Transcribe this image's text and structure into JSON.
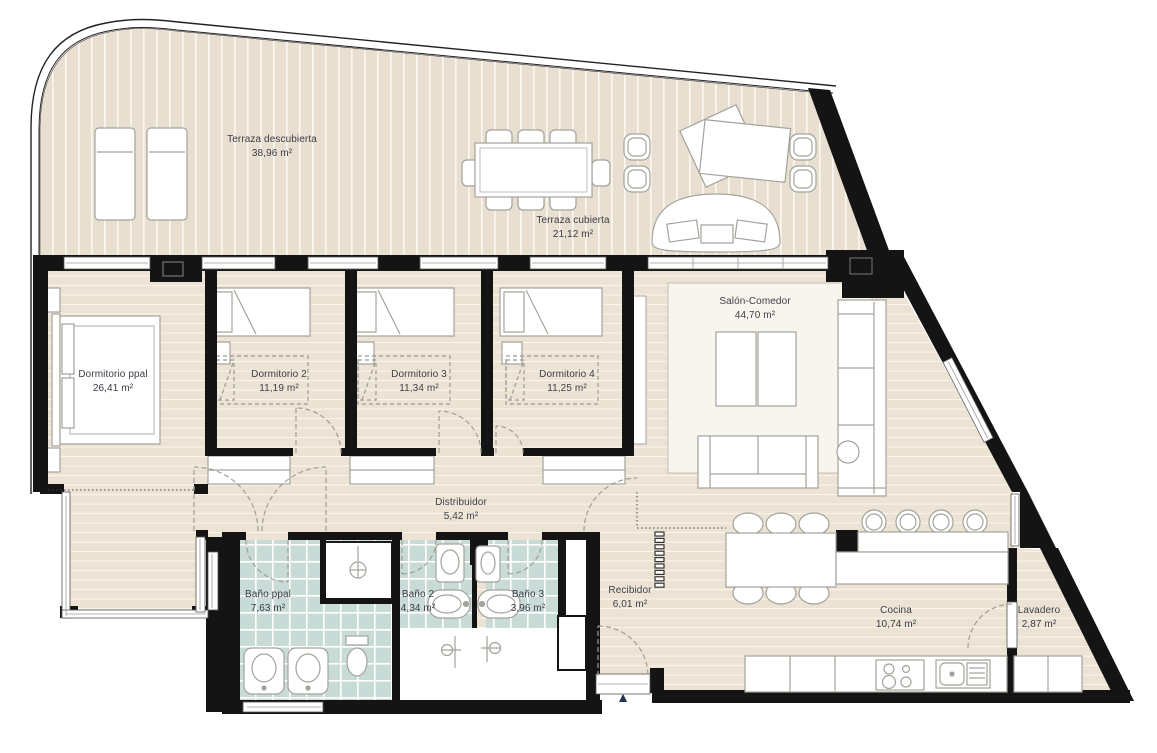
{
  "plan": {
    "type": "apartment floor plan",
    "entrance_marker": "▲",
    "rooms": [
      {
        "id": "terraza-descubierta",
        "name": "Terraza descubierta",
        "area": "38,96 m²"
      },
      {
        "id": "terraza-cubierta",
        "name": "Terraza cubierta",
        "area": "21,12 m²"
      },
      {
        "id": "dormitorio-ppal",
        "name": "Dormitorio ppal",
        "area": "26,41 m²"
      },
      {
        "id": "dormitorio-2",
        "name": "Dormitorio 2",
        "area": "11,19 m²"
      },
      {
        "id": "dormitorio-3",
        "name": "Dormitorio 3",
        "area": "11,34 m²"
      },
      {
        "id": "dormitorio-4",
        "name": "Dormitorio 4",
        "area": "11,25 m²"
      },
      {
        "id": "salon-comedor",
        "name": "Salón-Comedor",
        "area": "44,70 m²"
      },
      {
        "id": "distribuidor",
        "name": "Distribuidor",
        "area": "5,42 m²"
      },
      {
        "id": "bano-ppal",
        "name": "Baño ppal",
        "area": "7,63 m²"
      },
      {
        "id": "bano-2",
        "name": "Baño 2",
        "area": "4,34 m²"
      },
      {
        "id": "bano-3",
        "name": "Baño 3",
        "area": "3,96 m²"
      },
      {
        "id": "recibidor",
        "name": "Recibidor",
        "area": "6,01 m²"
      },
      {
        "id": "cocina",
        "name": "Cocina",
        "area": "10,74 m²"
      },
      {
        "id": "lavadero",
        "name": "Lavadero",
        "area": "2,87 m²"
      }
    ]
  },
  "colors": {
    "wall": "#141414",
    "terrace_deck": "#e8dfd0",
    "interior_floor": "#ece3d4",
    "bath_tile": "#c9dbd6",
    "furniture_stroke": "#a3a39b",
    "label_text": "#3c3c46",
    "entrance_marker": "#1e3553"
  }
}
